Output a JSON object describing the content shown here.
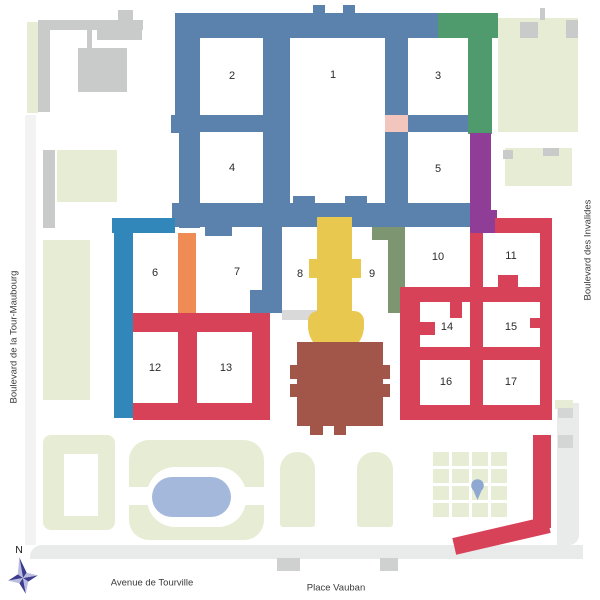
{
  "map": {
    "region_labels": {
      "street_left": "Boulevard de la Tour-Maubourg",
      "street_right": "Boulevard des Invalides",
      "street_bottom_left": "Avenue de Tourville",
      "street_bottom_right": "Place Vauban"
    },
    "compass_north": "N",
    "courtyard_labels": [
      "1",
      "2",
      "3",
      "4",
      "5",
      "6",
      "7",
      "8",
      "9",
      "10",
      "11",
      "12",
      "13",
      "14",
      "15",
      "16",
      "17"
    ],
    "colors": {
      "main_complex_blue": "#5b82ad",
      "west_wing_blue": "#3186ba",
      "green_wing": "#4f9b6e",
      "purple_wing": "#8f3d97",
      "pink_block": "#f3c6bd",
      "orange_gallery": "#ef8c55",
      "church_yellow": "#e8c84f",
      "olive_gallery": "#7e9571",
      "dome_brown": "#a2564a",
      "red_complex": "#d84258",
      "lawn": "#e7ecd4",
      "pond": "#a3b8da",
      "marker": "#8fa8d1",
      "neighbor_grey": "#c9caca",
      "neighbor_grey_light": "#d4d5d5",
      "road": "#e9eaea",
      "road_marking": "#cfd0d0",
      "walkway_grey": "#d9d9d9",
      "ink": "#2b2b2b",
      "compass_dark": "#3d3c8f",
      "compass_light": "#b9bcdf"
    }
  }
}
